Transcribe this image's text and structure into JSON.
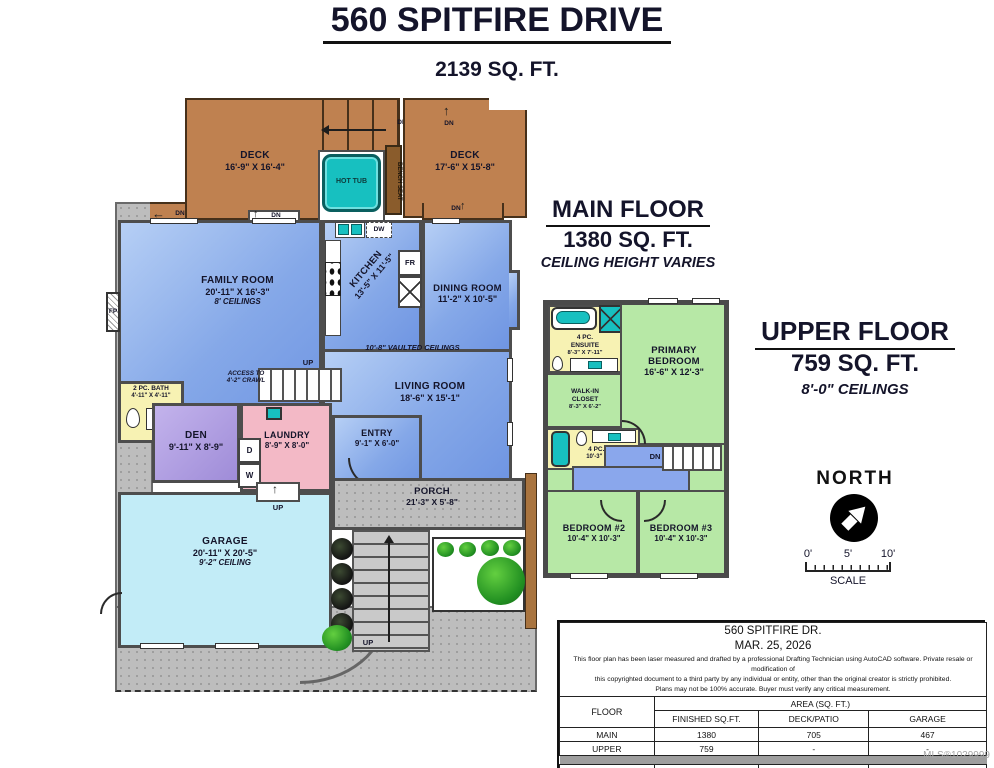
{
  "page": {
    "title": "560 SPITFIRE DRIVE",
    "subtitle": "2139 SQ. FT.",
    "watermark": "MLS®1029999"
  },
  "headings": {
    "main": {
      "title": "MAIN FLOOR",
      "sqft": "1380 SQ. FT.",
      "note": "CEILING HEIGHT VARIES"
    },
    "upper": {
      "title": "UPPER FLOOR",
      "sqft": "759 SQ. FT.",
      "note": "8'-0\" CEILINGS"
    }
  },
  "labels": {
    "dn": "DN",
    "up": "UP",
    "dw": "DW",
    "fr": "FR",
    "fp": "FP",
    "d": "D",
    "w": "W",
    "north": "NORTH",
    "scale": "SCALE",
    "s0": "0'",
    "s5": "5'",
    "s10": "10'"
  },
  "main_floor": {
    "deck_left": {
      "name": "DECK",
      "dims": "16'-9\" X 16'-4\""
    },
    "deck_right": {
      "name": "DECK",
      "dims": "17'-6\" X 15'-8\""
    },
    "hot_tub": {
      "name": "HOT TUB"
    },
    "bench": {
      "name": "BENCH SEAT"
    },
    "family": {
      "name": "FAMILY ROOM",
      "dims": "20'-11\" X 16'-3\"",
      "note": "8' CEILINGS"
    },
    "kitchen": {
      "name": "KITCHEN",
      "dims": "13'-5\" X 11'-5\""
    },
    "dining": {
      "name": "DINING ROOM",
      "dims": "11'-2\" X 10'-5\""
    },
    "living": {
      "name": "LIVING ROOM",
      "dims": "18'-6\" X 15'-1\""
    },
    "vaulted": "10'-8\" VAULTED CEILINGS",
    "bath": {
      "name": "2 PC. BATH",
      "dims": "4'-11\" X 4'-11\""
    },
    "den": {
      "name": "DEN",
      "dims": "9'-11\" X 8'-9\""
    },
    "laundry": {
      "name": "LAUNDRY",
      "dims": "8'-9\" X 8'-0\""
    },
    "entry": {
      "name": "ENTRY",
      "dims": "9'-1\" X 6'-0\""
    },
    "porch": {
      "name": "PORCH",
      "dims": "21'-3\" X 5'-8\""
    },
    "garage": {
      "name": "GARAGE",
      "dims": "20'-11\" X 20'-5\"",
      "note": "9'-2\" CEILING"
    },
    "access": "ACCESS TO 4'-2\" CRAWL"
  },
  "upper_floor": {
    "ensuite": {
      "name1": "4 PC.",
      "name2": "ENSUITE",
      "dims": "8'-3\" X 7'-11\""
    },
    "primary": {
      "name1": "PRIMARY",
      "name2": "BEDROOM",
      "dims": "16'-6\" X 12'-3\""
    },
    "closet": {
      "name1": "WALK-IN",
      "name2": "CLOSET",
      "dims": "8'-3\" X 6'-2\""
    },
    "bath": {
      "name": "4 PC. BATH",
      "dims": "10'-3\" X 4'-11\""
    },
    "bedroom2": {
      "name": "BEDROOM #2",
      "dims": "10'-4\" X 10'-3\""
    },
    "bedroom3": {
      "name": "BEDROOM #3",
      "dims": "10'-4\" X 10'-3\""
    }
  },
  "table": {
    "address": "560 SPITFIRE DR.",
    "date": "MAR. 25, 2026",
    "disclaimer": [
      "This floor plan has been laser measured and drafted by a professional Drafting Technician using AutoCAD software. Private resale or modification of",
      "this copyrighted document to a third party by any individual or entity, other than the original creator is strictly prohibited.",
      "Plans may not be 100% accurate.  Buyer must verify any critical measurement."
    ],
    "floor_col": "FLOOR",
    "area_col": "AREA (SQ. FT.)",
    "headers": [
      "FINISHED SQ.FT.",
      "DECK/PATIO",
      "GARAGE"
    ],
    "rows": [
      {
        "floor": "MAIN",
        "finished": "1380",
        "deck": "705",
        "garage": "467"
      },
      {
        "floor": "UPPER",
        "finished": "759",
        "deck": "-",
        "garage": "-"
      }
    ],
    "total": {
      "floor": "TOTAL",
      "finished": "2139",
      "deck": "705",
      "garage": "467"
    }
  },
  "colors": {
    "deck_brown": "#bf8150",
    "room_blue": "#7fa3e6",
    "garage_cyan": "#c2ecf7",
    "den_purple": "#b3a0e4",
    "laundry_pink": "#f3b9c6",
    "bath_yellow": "#f7f2b3",
    "bedroom_green": "#b7e8a6",
    "hall_blue": "#8aa7ec",
    "hot_tub_teal": "#17c0c0",
    "concrete_gray": "#bdbdbd"
  }
}
